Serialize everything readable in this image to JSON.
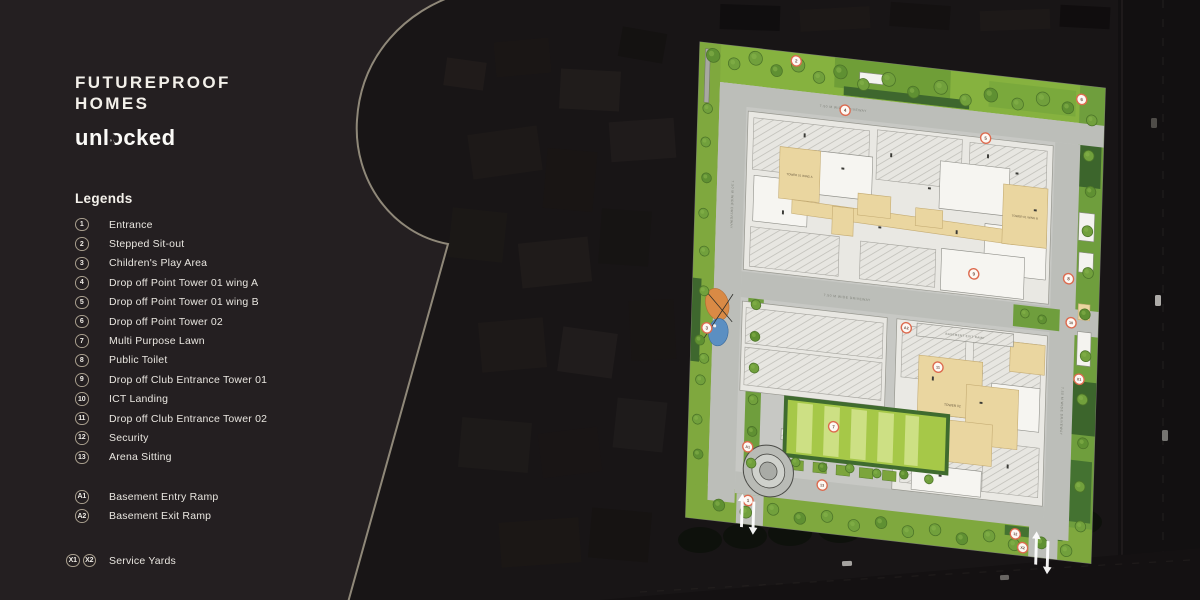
{
  "brand": {
    "line1": "FUTUREPROOF",
    "line2": "HOMES",
    "tagline": "unlocked"
  },
  "legend": {
    "title": "Legends",
    "items": [
      {
        "badges": [
          "1"
        ],
        "label": "Entrance"
      },
      {
        "badges": [
          "2"
        ],
        "label": "Stepped Sit-out"
      },
      {
        "badges": [
          "3"
        ],
        "label": "Children's Play Area"
      },
      {
        "badges": [
          "4"
        ],
        "label": "Drop off Point Tower 01 wing A"
      },
      {
        "badges": [
          "5"
        ],
        "label": "Drop off Point Tower 01 wing B"
      },
      {
        "badges": [
          "6"
        ],
        "label": "Drop off Point Tower 02"
      },
      {
        "badges": [
          "7"
        ],
        "label": "Multi Purpose Lawn"
      },
      {
        "badges": [
          "8"
        ],
        "label": "Public Toilet"
      },
      {
        "badges": [
          "9"
        ],
        "label": "Drop off Club Entrance Tower 01"
      },
      {
        "badges": [
          "10"
        ],
        "label": "ICT Landing"
      },
      {
        "badges": [
          "11"
        ],
        "label": "Drop off Club Entrance Tower 02"
      },
      {
        "badges": [
          "12"
        ],
        "label": "Security"
      },
      {
        "badges": [
          "13"
        ],
        "label": "Arena Sitting"
      }
    ],
    "ramps": [
      {
        "badges": [
          "A1"
        ],
        "label": "Basement Entry Ramp"
      },
      {
        "badges": [
          "A2"
        ],
        "label": "Basement Exit Ramp"
      }
    ],
    "service": {
      "badges": [
        "X1",
        "X2"
      ],
      "label": "Service Yards"
    }
  },
  "plan": {
    "road_label": "7.50 M WIDE DRIVEWAY",
    "labels": {
      "tower1a": "TOWER 01 WING A",
      "tower1b": "TOWER 01 WING B",
      "tower2": "TOWER 02",
      "basement_exit": "BASEMENT EXIT RAMP",
      "basement_entry": "BASEMENT ENTRY RAMP"
    },
    "markers": [
      {
        "label": "1",
        "x": 64,
        "y": 456
      },
      {
        "label": "2",
        "x": 100,
        "y": 8
      },
      {
        "label": "3",
        "x": 16,
        "y": 287
      },
      {
        "label": "4",
        "x": 152,
        "y": 52
      },
      {
        "label": "5",
        "x": 298,
        "y": 64
      },
      {
        "label": "6",
        "x": 396,
        "y": 14
      },
      {
        "label": "7",
        "x": 150,
        "y": 372
      },
      {
        "label": "8",
        "x": 388,
        "y": 196
      },
      {
        "label": "9",
        "x": 290,
        "y": 202
      },
      {
        "label": "10",
        "x": 392,
        "y": 240
      },
      {
        "label": "11",
        "x": 256,
        "y": 300
      },
      {
        "label": "12",
        "x": 341,
        "y": 459
      },
      {
        "label": "13",
        "x": 140,
        "y": 432
      },
      {
        "label": "A1",
        "x": 62,
        "y": 402
      },
      {
        "label": "A2",
        "x": 222,
        "y": 264
      },
      {
        "label": "X1",
        "x": 402,
        "y": 296
      },
      {
        "label": "X2",
        "x": 349,
        "y": 472
      }
    ]
  },
  "colors": {
    "marker_ring": "#dd6a4e",
    "lawn_green": "#a6c848",
    "strip_green": "#7fa83e",
    "building_cream": "#ead6a0",
    "keyhole_line": "#968e7e",
    "panel_bg": "#241f21"
  }
}
